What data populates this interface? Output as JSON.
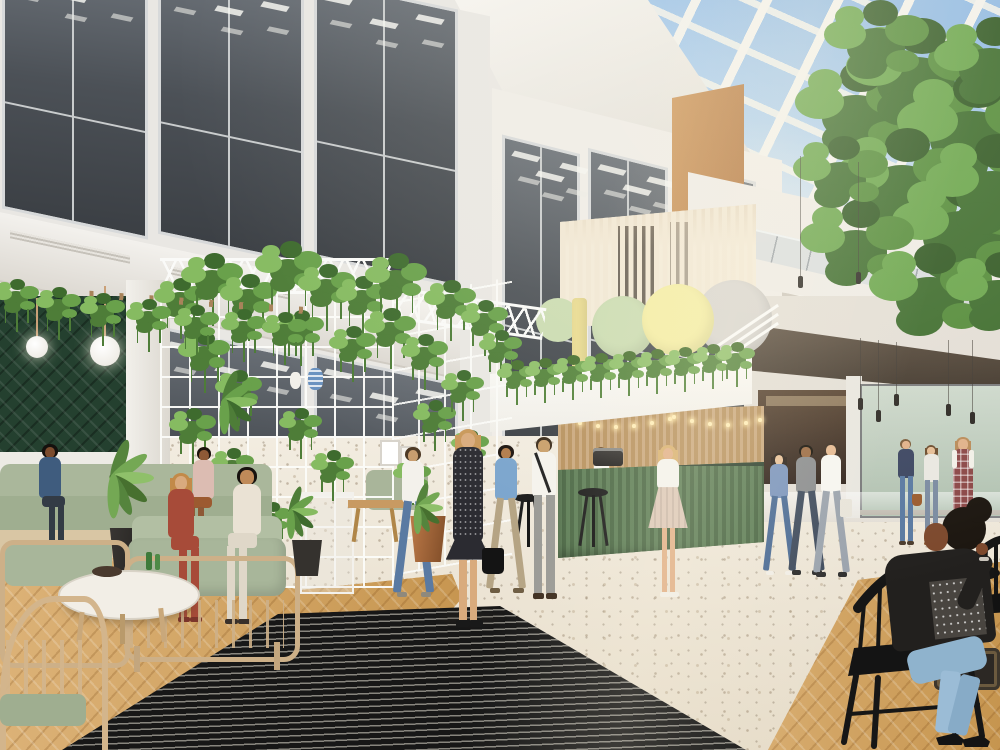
{
  "scene_title": "Office atrium interior rendering",
  "signage": {
    "directory_rows": [
      {
        "floor": "2",
        "name": "101 Designs"
      },
      {
        "floor": "1",
        "name": "Cubik Studio"
      },
      {
        "floor": "G",
        "name": "FancyLiving Ltd"
      }
    ],
    "logo_text": "1000",
    "logo_bar_color": "#e9db92",
    "logo_circle_colors": [
      "#cbdcb2",
      "#f4eda4",
      "#d8d5d0"
    ]
  },
  "palette": {
    "sky_blue": "#9fc2e6",
    "skylight_frame": "#f2f1ec",
    "facade_white": "#e9e7e3",
    "window_glass": "#51565c",
    "wood_slat": "#c9a87c",
    "wood_column": "#c08449",
    "bar_green": "#577551",
    "foliage_green": "#5d8a44",
    "terrazzo_floor": "#ece4d6",
    "parquet_floor": "#d5a96b",
    "entrance_mat": "#171717",
    "sofa_sage": "#a8b69a",
    "tile_wall_green": "#24402f"
  }
}
